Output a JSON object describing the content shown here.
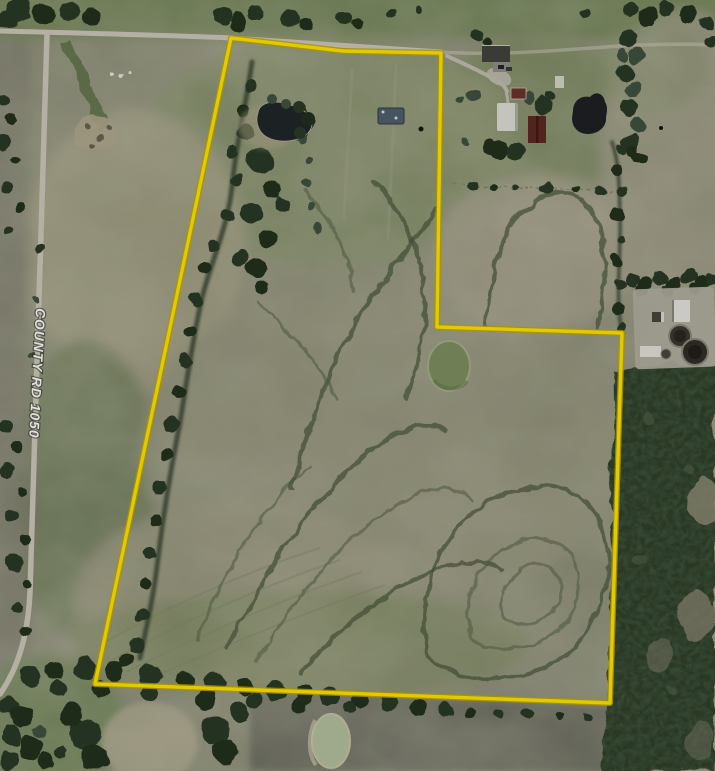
{
  "map": {
    "kind": "aerial-parcel-view",
    "road_label": "COUNTY RD 1050",
    "boundary": {
      "points": "231,38 343,51 441,53 437,327 622,333 610,703 95,684",
      "color": "#ffe800",
      "edge_color": "#c8a600"
    },
    "palette": {
      "boundary-color": "#ffe800",
      "boundary-edge": "#c8a600",
      "road-color": "#cdc9ba",
      "driveway-color": "#c3c0b1",
      "label-color": "#ffffff",
      "field-base": "#8f907a",
      "grass-green": "#6e8153",
      "tree-dark": "#2c3a28",
      "forest-green": "#31402c",
      "water-dark": "#20262a",
      "water-green": "#7f9160",
      "water-pale": "#b6c3a0",
      "plowed-field": "#6c6d60"
    },
    "features": [
      {
        "name": "property-boundary",
        "kind": "outlined parcel"
      },
      {
        "name": "county-rd-1050",
        "kind": "road"
      },
      {
        "name": "north-road",
        "kind": "road"
      },
      {
        "name": "farmstead",
        "kind": "buildings with barns"
      },
      {
        "name": "grain-facility",
        "kind": "industrial pad with tanks"
      },
      {
        "name": "northwest-pond",
        "kind": "pond"
      },
      {
        "name": "farmstead-pond",
        "kind": "pond"
      },
      {
        "name": "center-pond",
        "kind": "pond"
      },
      {
        "name": "south-pond",
        "kind": "pond"
      },
      {
        "name": "east-forest",
        "kind": "woodland"
      },
      {
        "name": "creek-treeline",
        "kind": "drainage"
      },
      {
        "name": "contour-terraces",
        "kind": "field contour lines"
      }
    ]
  }
}
